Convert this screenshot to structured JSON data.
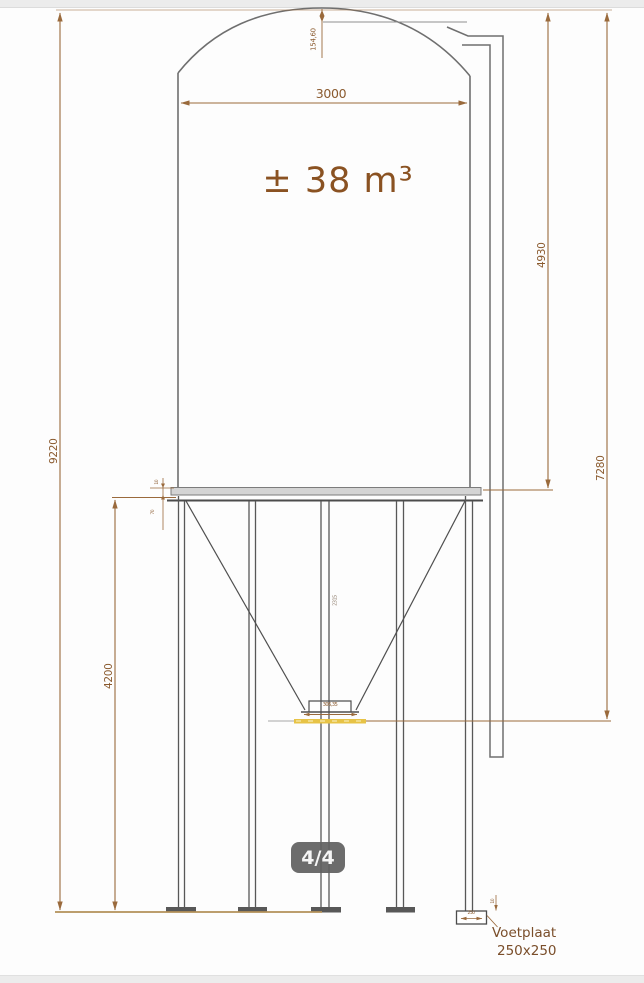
{
  "viewer": {
    "page_indicator": "4/4"
  },
  "drawing": {
    "volume_label": "± 38 m³",
    "dimensions": {
      "dome_height": "154,60",
      "tank_diameter": "3000",
      "tank_height": "4930",
      "silo_to_outlet_height": "7280",
      "overall_height": "9220",
      "leg_height": "4200",
      "cone_height": "2315",
      "outlet_width": "306,35",
      "rim_offset_top": "10",
      "rim_offset_bottom": "70",
      "footplate_width": "250",
      "footplate_thickness": "10"
    },
    "footplate_callout": {
      "label": "Voetplaat",
      "size": "250x250"
    },
    "colors": {
      "dimension_lines": "#9a6a3c",
      "dimension_text": "#8a5a2e",
      "volume_text": "#8a5222",
      "steel_lines": "#6f6f6f",
      "outlet_highlight": "#e7c346",
      "badge_background": "#5f5f5f"
    }
  }
}
